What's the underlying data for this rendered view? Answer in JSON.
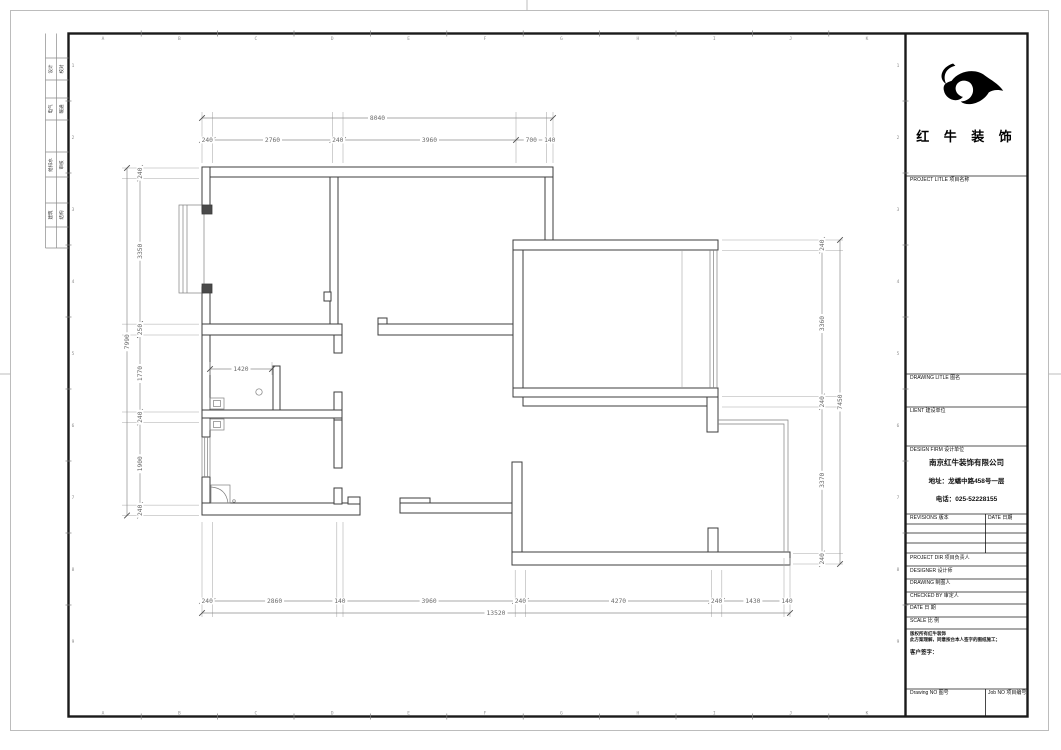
{
  "sheet": {
    "grid_letters": [
      "A",
      "B",
      "C",
      "D",
      "E",
      "F",
      "G",
      "H",
      "I",
      "J",
      "K"
    ],
    "grid_numbers": [
      "1",
      "2",
      "3",
      "4",
      "5",
      "6",
      "7",
      "8",
      "9"
    ],
    "signoff_rows": [
      {
        "left": "设计",
        "right": "校对"
      },
      {
        "left": "电气",
        "right": "暖通"
      },
      {
        "left": "给排水",
        "right": "审核"
      },
      {
        "left": "建筑",
        "right": "结构"
      }
    ]
  },
  "title_block": {
    "brand_name": "红 牛 装 饰",
    "project_title_label": "PROJECT LITLE   项目名称",
    "drawing_title_label": "DRAWING LITLE   图名",
    "client_label": "LIENT  建设单位",
    "design_firm_label": "DESIGN FIRM  设计单位",
    "company_name": "南京红牛装饰有限公司",
    "company_address": "地址：龙蟠中路458号一层",
    "company_phone": "电话：025-52228155",
    "revisions_label": "REVISIONS  版本",
    "revisions_date_label": "DATE 日期",
    "project_dir_label": "PROJECT DIR   项目负责人",
    "designer_label": "DESIGNER      设计师",
    "drawing_label": "DRAWING       制图人",
    "checked_by_label": "CHECKED BY    审定人",
    "date_label": "DATE          日  期",
    "scale_label": "SCALE         比  例",
    "copyright_line1": "版权所有红牛装饰",
    "copyright_line2": "此方案理解，同意按台本人签字的图纸施工；",
    "customer_sign_label": "客户签字：",
    "drawing_no_label": "Drawing NO  图号",
    "job_no_label": "Job NO  项目编号"
  },
  "plan": {
    "dims_top": [
      "240",
      "2760",
      "240",
      "3960",
      "700",
      "140"
    ],
    "dims_top_overall": "8040",
    "dims_bottom": [
      "240",
      "2860",
      "140",
      "3960",
      "240",
      "4270",
      "240",
      "1430",
      "140"
    ],
    "dims_bottom_overall": "13520",
    "dims_left": [
      "240",
      "3350",
      "250",
      "1770",
      "240",
      "1900",
      "240"
    ],
    "dims_left_overall": "7990",
    "dims_right": [
      "240",
      "3360",
      "240",
      "3370",
      "240"
    ],
    "dims_right_overall": "7450",
    "dim_interior": "1420"
  },
  "colors": {
    "wall_line": "#3d3d3d",
    "dim_line": "#8d8d8d",
    "dim_text": "#6b6b6b",
    "frame": "#1a1a1a",
    "logo": "#000000"
  }
}
